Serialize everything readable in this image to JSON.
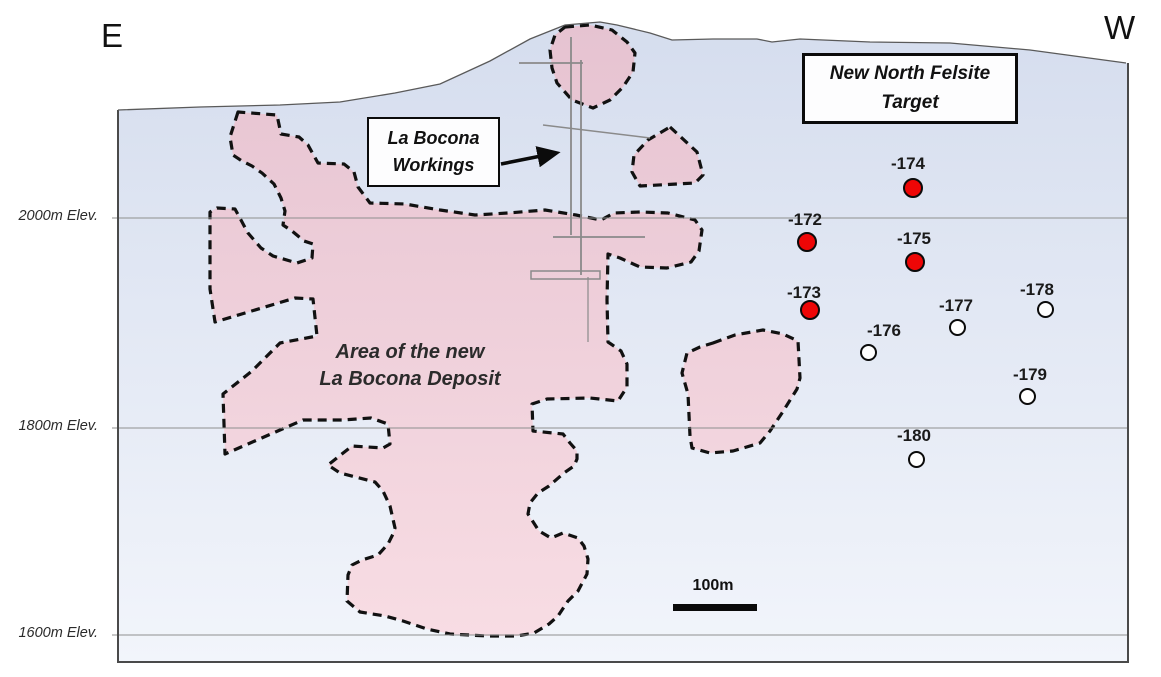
{
  "compass": {
    "east": "E",
    "west": "W"
  },
  "elevation_labels": [
    {
      "text": "2000m Elev.",
      "y": 218
    },
    {
      "text": "1800m Elev.",
      "y": 428
    },
    {
      "text": "1600m Elev.",
      "y": 635
    }
  ],
  "callouts": {
    "workings": {
      "line1": "La Bocona",
      "line2": "Workings"
    },
    "felsite": {
      "line1": "New North Felsite",
      "line2": "Target"
    },
    "deposit": {
      "line1": "Area of the new",
      "line2": "La Bocona Deposit"
    }
  },
  "scale_bar": {
    "label": "100m"
  },
  "drill_holes": [
    {
      "id": "-172",
      "marker": "red",
      "cx": 807,
      "cy": 242,
      "label_cx": 805,
      "label_cy": 219
    },
    {
      "id": "-173",
      "marker": "red",
      "cx": 810,
      "cy": 310,
      "label_cx": 804,
      "label_cy": 292
    },
    {
      "id": "-174",
      "marker": "red",
      "cx": 913,
      "cy": 188,
      "label_cx": 908,
      "label_cy": 163
    },
    {
      "id": "-175",
      "marker": "red",
      "cx": 915,
      "cy": 262,
      "label_cx": 914,
      "label_cy": 238
    },
    {
      "id": "-176",
      "marker": "white",
      "cx": 868,
      "cy": 352,
      "label_cx": 884,
      "label_cy": 330
    },
    {
      "id": "-177",
      "marker": "white",
      "cx": 957,
      "cy": 327,
      "label_cx": 956,
      "label_cy": 305
    },
    {
      "id": "-178",
      "marker": "white",
      "cx": 1045,
      "cy": 309,
      "label_cx": 1037,
      "label_cy": 289
    },
    {
      "id": "-179",
      "marker": "white",
      "cx": 1027,
      "cy": 396,
      "label_cx": 1030,
      "label_cy": 374
    },
    {
      "id": "-180",
      "marker": "white",
      "cx": 916,
      "cy": 459,
      "label_cx": 914,
      "label_cy": 435
    }
  ],
  "colors": {
    "marker_red": "#ee0606",
    "marker_white": "#ffffff",
    "marker_outline": "#0b0b0b",
    "felsite_pink_top": "#e6c3d1",
    "felsite_pink_bottom": "#f8dde4",
    "sky_top": "#d5ddee",
    "sky_bottom": "#f2f5fb",
    "gridline": "#8f8f8f",
    "workings_gray": "#8a8a8a",
    "border": "#4a4a4a"
  }
}
